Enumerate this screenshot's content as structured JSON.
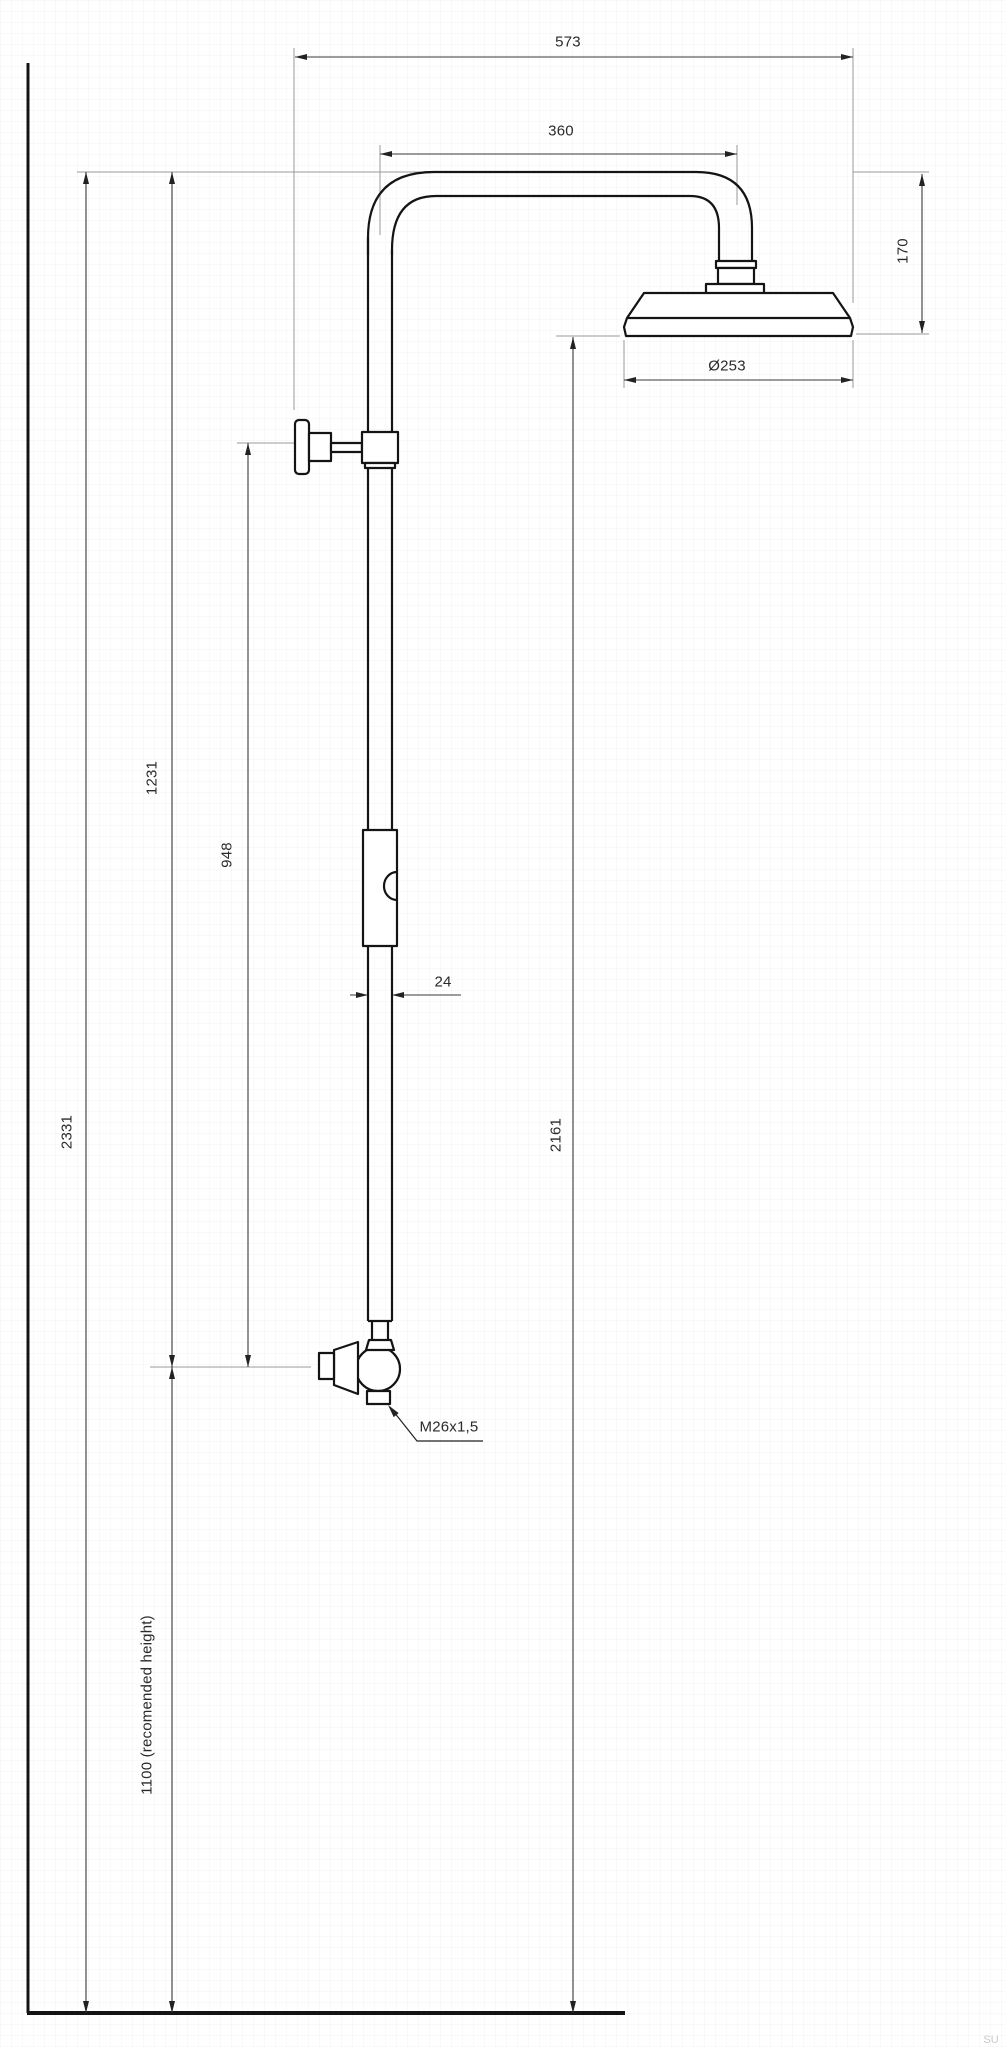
{
  "diagram": {
    "watermark": "SU",
    "colors": {
      "outline": "#141414",
      "dimension_line": "#3a3a3a",
      "extension_line": "#9a9a9a",
      "label_text": "#2a2a2a",
      "background": "#ffffff",
      "watermark": "#c9c9c9"
    },
    "labels": {
      "overall_width": "573",
      "arm_reach": "360",
      "head_height": "170",
      "head_diameter": "Ø253",
      "top_to_mixer": "1231",
      "bracket_to_mixer": "948",
      "total_height": "2331",
      "pipe_diameter": "24",
      "floor_to_head": "2161",
      "mixer_thread": "M26x1,5",
      "mixer_height": "1100 (recomended height)"
    }
  }
}
